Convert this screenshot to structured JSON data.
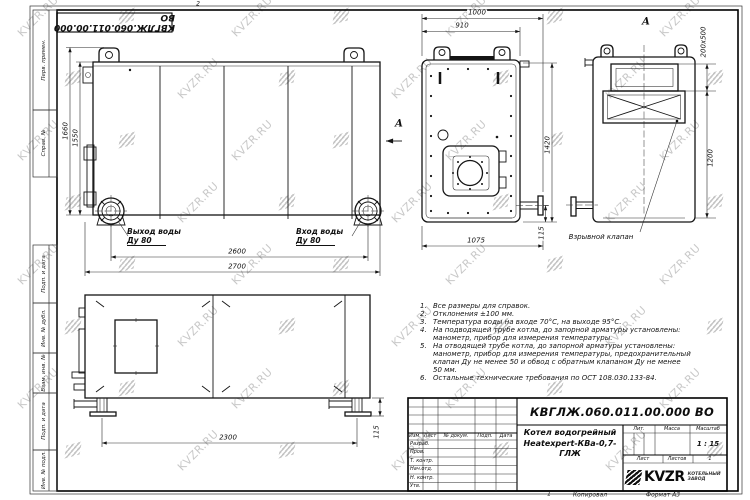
{
  "watermark": {
    "text": "KVZR.RU"
  },
  "sheet": {
    "top_stamp": "КВГЛЖ.060.011.00.000 ВО",
    "margin_labels": [
      {
        "t": "Перв. примен.",
        "x": 44,
        "y": 60
      },
      {
        "t": "Справ. №",
        "x": 44,
        "y": 143
      },
      {
        "t": "Подп. и дата",
        "x": 44,
        "y": 274
      },
      {
        "t": "Инв. № дубл.",
        "x": 44,
        "y": 328
      },
      {
        "t": "Взам. инв. №",
        "x": 44,
        "y": 373
      },
      {
        "t": "Подп. и дата",
        "x": 44,
        "y": 421
      },
      {
        "t": "Инв. № подл.",
        "x": 44,
        "y": 470
      }
    ],
    "zone_marks": [
      {
        "t": "2",
        "x": 198,
        "y": 4,
        "cls": "zone"
      },
      {
        "t": "1",
        "x": 549,
        "y": 494,
        "cls": "zone"
      }
    ]
  },
  "dimensions": [
    {
      "t": "1660",
      "x": 66,
      "y": 131,
      "rot": 1
    },
    {
      "t": "1550",
      "x": 76,
      "y": 138,
      "rot": 1
    },
    {
      "t": "2600",
      "x": 237,
      "y": 252
    },
    {
      "t": "2700",
      "x": 237,
      "y": 267
    },
    {
      "t": "1000",
      "x": 477,
      "y": 13
    },
    {
      "t": "910",
      "x": 462,
      "y": 26
    },
    {
      "t": "1420",
      "x": 548,
      "y": 145,
      "rot": 1
    },
    {
      "t": "115",
      "x": 542,
      "y": 233,
      "rot": 1
    },
    {
      "t": "1075",
      "x": 476,
      "y": 241
    },
    {
      "t": "200x500",
      "x": 704,
      "y": 42,
      "rot": 1
    },
    {
      "t": "1200",
      "x": 711,
      "y": 158,
      "rot": 1
    },
    {
      "t": "2300",
      "x": 228,
      "y": 438
    },
    {
      "t": "115",
      "x": 377,
      "y": 432,
      "rot": 1
    }
  ],
  "view_labels": [
    {
      "t": "А",
      "x": 399,
      "y": 124,
      "cls": "big"
    },
    {
      "t": "А",
      "x": 646,
      "y": 22,
      "cls": "big"
    },
    {
      "t": "Взрывной клапан",
      "x": 601,
      "y": 237,
      "cls": "mid"
    }
  ],
  "pipe_labels": [
    {
      "l1": "Выход воды",
      "l2": "Ду 80",
      "x": 127,
      "y": 227
    },
    {
      "l1": "Вход воды",
      "l2": "Ду 80",
      "x": 296,
      "y": 227
    }
  ],
  "notes": {
    "lines": [
      {
        "n": "1.",
        "t": "Все размеры для справок."
      },
      {
        "n": "2.",
        "t": "Отклонения ±100 мм."
      },
      {
        "n": "3.",
        "t": "Температура воды на входе 70°С, на выходе 95°С."
      },
      {
        "n": "4.",
        "t": "На подводящей трубе котла, до запорной арматуры установлены:"
      },
      {
        "n": "",
        "t": "манометр, прибор для измерения температуры."
      },
      {
        "n": "5.",
        "t": "На отводящей трубе котла, до запорной арматуры установлены:"
      },
      {
        "n": "",
        "t": "манометр, прибор для измерения температуры, предохранительный"
      },
      {
        "n": "",
        "t": "клапан Ду не менее 50 и обвод с обратным клапаном Ду не менее"
      },
      {
        "n": "",
        "t": "50 мм."
      },
      {
        "n": "6.",
        "t": "Остальные технические требования по ОСТ 108.030.133-84."
      }
    ]
  },
  "title_block": {
    "doc_number": "КВГЛЖ.060.011.00.000 ВО",
    "product_name_1": "Котел водогрейный",
    "product_name_2": "Heatexpert-КВа-0,7-ГЛЖ",
    "header_cells": [
      {
        "t": "Изм.",
        "x": 415,
        "y": 436
      },
      {
        "t": "Лист",
        "x": 430,
        "y": 436
      },
      {
        "t": "№ докум.",
        "x": 456,
        "y": 436
      },
      {
        "t": "Подп.",
        "x": 485,
        "y": 436
      },
      {
        "t": "Дата",
        "x": 506,
        "y": 436
      }
    ],
    "row_labels": [
      {
        "t": "Разраб.",
        "x": 410,
        "y": 444
      },
      {
        "t": "Пров.",
        "x": 410,
        "y": 452
      },
      {
        "t": "Т. контр.",
        "x": 410,
        "y": 461
      },
      {
        "t": "Нач.отд.",
        "x": 410,
        "y": 469
      },
      {
        "t": "Н. контр.",
        "x": 410,
        "y": 478
      },
      {
        "t": "Утв.",
        "x": 410,
        "y": 486
      }
    ],
    "right_cells": [
      {
        "t": "Лит.",
        "x": 639,
        "y": 429
      },
      {
        "t": "Масса",
        "x": 672,
        "y": 429
      },
      {
        "t": "Масштаб",
        "x": 708,
        "y": 429
      },
      {
        "t": "1 : 15",
        "x": 708,
        "y": 444,
        "cls": "mid"
      },
      {
        "t": "Лист",
        "x": 643,
        "y": 459
      },
      {
        "t": "Листов",
        "x": 677,
        "y": 459
      },
      {
        "t": "1",
        "x": 710,
        "y": 459
      }
    ],
    "logo_word": "KVZR",
    "logo_sub_1": "КОТЕЛЬНЫЙ",
    "logo_sub_2": "ЗАВОД",
    "footer_copied": "Копировал",
    "footer_format": "Формат А3"
  }
}
